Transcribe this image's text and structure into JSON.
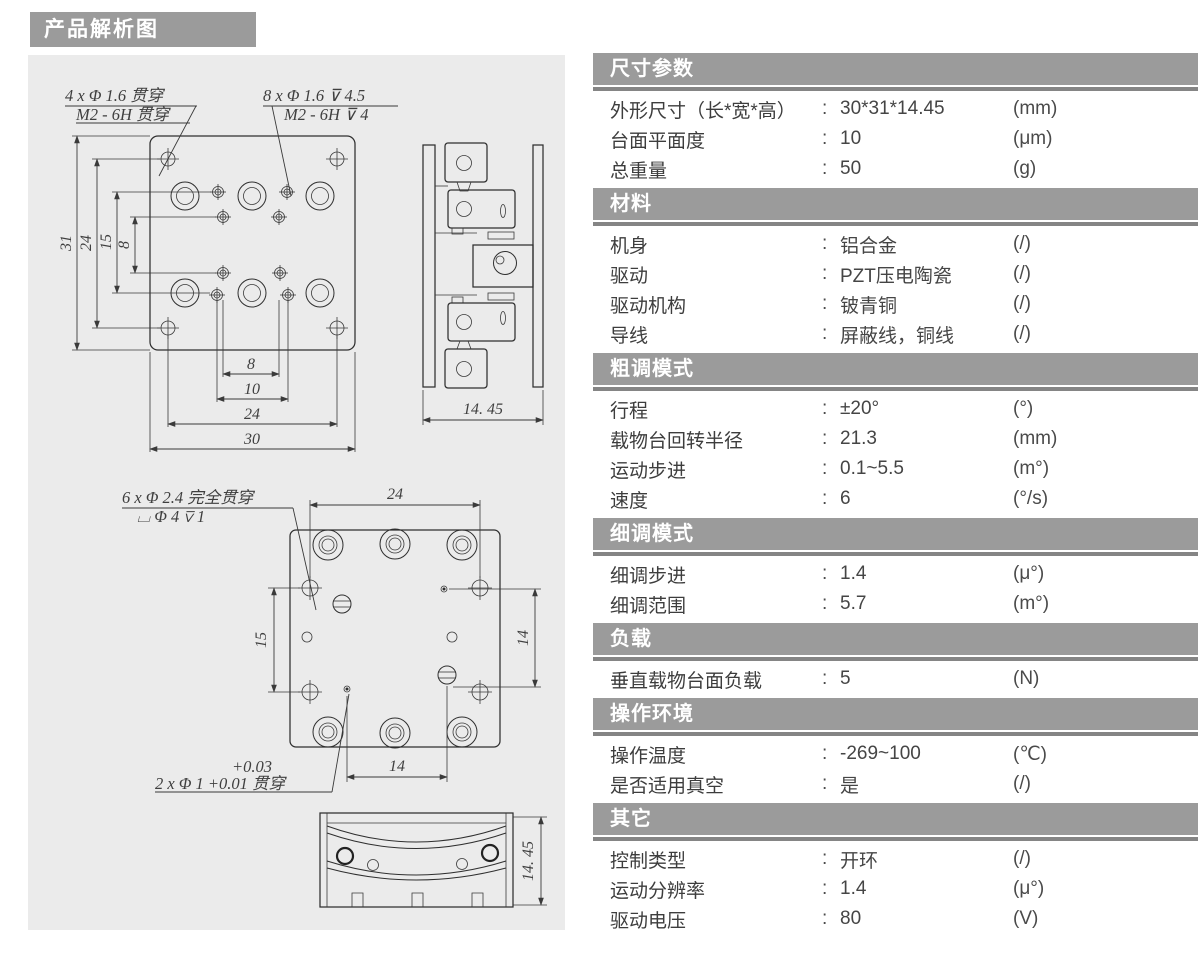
{
  "page_title": "产品解析图",
  "drawings": {
    "top_view": {
      "callout_left": [
        "4 x Φ 1.6 贯穿",
        "M2 - 6H 贯穿"
      ],
      "callout_right": [
        "8 x Φ 1.6 ⊽ 4.5",
        "M2 - 6H ⊽ 4"
      ],
      "dims": {
        "height": "31",
        "hole_span_v": "24",
        "screw_span_v": "15",
        "inner_span_v": "8",
        "inner_span_h": "8",
        "screw_span_h": "10",
        "hole_span_h": "24",
        "width": "30"
      }
    },
    "side_view": {
      "dim_depth": "14. 45"
    },
    "bottom_view": {
      "callout_counterbore": [
        "6 x Φ 2.4 完全贯穿",
        "⌴ Φ 4 ⊽ 1"
      ],
      "callout_pin": [
        "+0.03",
        "2 x Φ 1 +0.01 贯穿"
      ],
      "dims": {
        "top": "24",
        "left": "15",
        "right": "14",
        "bottom": "14"
      }
    },
    "front_view": {
      "dim_height": "14. 45"
    }
  },
  "spec": {
    "colon": ":",
    "sections": [
      {
        "title": "尺寸参数",
        "rows": [
          {
            "label": "外形尺寸（长*宽*高）",
            "value": "30*31*14.45",
            "unit": "(mm)"
          },
          {
            "label": "台面平面度",
            "value": "10",
            "unit": "(μm)"
          },
          {
            "label": "总重量",
            "value": "50",
            "unit": "(g)"
          }
        ]
      },
      {
        "title": "材料",
        "rows": [
          {
            "label": "机身",
            "value": "铝合金",
            "unit": "(/)"
          },
          {
            "label": "驱动",
            "value": "PZT压电陶瓷",
            "unit": "(/)"
          },
          {
            "label": "驱动机构",
            "value": "铍青铜",
            "unit": "(/)"
          },
          {
            "label": "导线",
            "value": "屏蔽线，铜线",
            "unit": "(/)"
          }
        ]
      },
      {
        "title": "粗调模式",
        "rows": [
          {
            "label": "行程",
            "value": "±20°",
            "unit": "(°)"
          },
          {
            "label": "载物台回转半径",
            "value": "21.3",
            "unit": "(mm)"
          },
          {
            "label": "运动步进",
            "value": "0.1~5.5",
            "unit": "(m°)"
          },
          {
            "label": "速度",
            "value": "6",
            "unit": "(°/s)"
          }
        ]
      },
      {
        "title": "细调模式",
        "rows": [
          {
            "label": "细调步进",
            "value": "1.4",
            "unit": "(μ°)"
          },
          {
            "label": "细调范围",
            "value": "5.7",
            "unit": "(m°)"
          }
        ]
      },
      {
        "title": "负载",
        "rows": [
          {
            "label": "垂直载物台面负载",
            "value": "5",
            "unit": "(N)"
          }
        ]
      },
      {
        "title": "操作环境",
        "rows": [
          {
            "label": "操作温度",
            "value": "-269~100",
            "unit": "(℃)"
          },
          {
            "label": "是否适用真空",
            "value": "是",
            "unit": "(/)"
          }
        ]
      },
      {
        "title": "其它",
        "rows": [
          {
            "label": "控制类型",
            "value": "开环",
            "unit": "(/)"
          },
          {
            "label": "运动分辨率",
            "value": "1.4",
            "unit": "(μ°)"
          },
          {
            "label": "驱动电压",
            "value": "80",
            "unit": "(V)"
          }
        ]
      }
    ]
  }
}
